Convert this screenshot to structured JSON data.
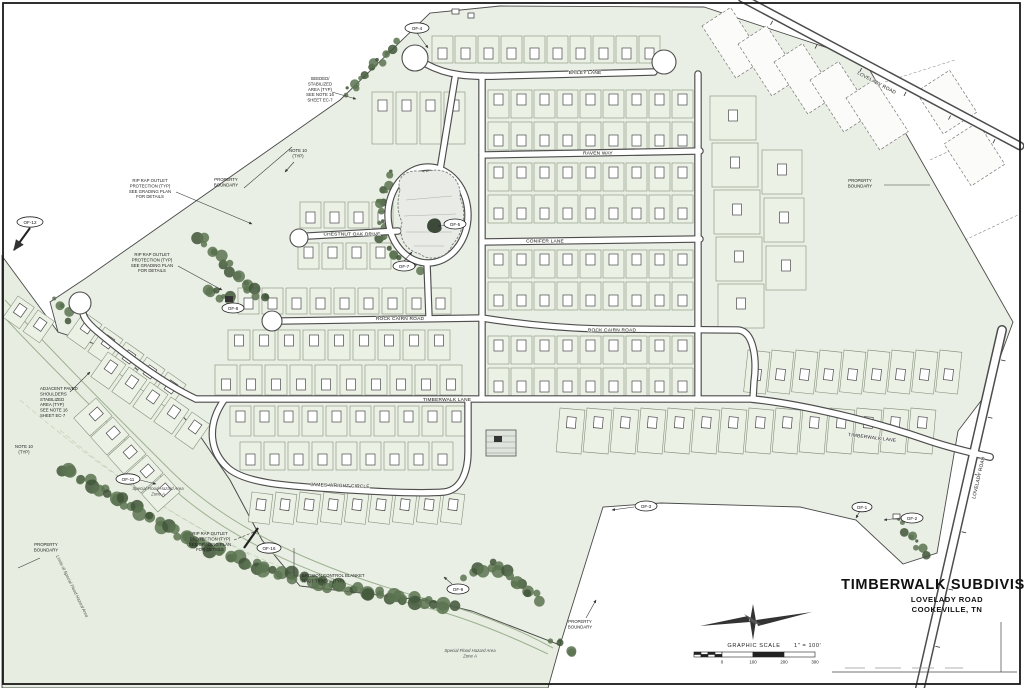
{
  "title_block": {
    "title": "TIMBERWALK SUBDIVISION",
    "road": "LOVELADY ROAD",
    "city": "COOKEVILLE, TN"
  },
  "scale_bar": {
    "label": "GRAPHIC SCALE",
    "ratio": "1\" = 100'",
    "ticks": [
      "0",
      "100",
      "200",
      "300"
    ]
  },
  "streets": {
    "bailey": "BAILEY LANE",
    "raven": "RAVEN WAY",
    "conifer": "CONIFER LANE",
    "rock_cairn_w": "ROCK CAIRN ROAD",
    "rock_cairn_e": "ROCK CAIRN ROAD",
    "chestnut": "CHESTNUT OAK DRIVE",
    "timberwalk_w": "TIMBERWALK LANE",
    "timberwalk_e": "TIMBERWALK LANE",
    "james_wright": "JAMES WRIGHT CIRCLE",
    "lovelady": "LOVELADY ROAD"
  },
  "callouts": {
    "of_12": "OF-12",
    "of_4": "OF-4",
    "of_5": "OF-5",
    "of_7": "OF-7",
    "of_8": "OF-8",
    "of_11": "OF-11",
    "of_16": "OF-16",
    "of_9": "OF-9",
    "of_3": "OF-3",
    "of_1": "OF-1",
    "of_2": "OF-2"
  },
  "notes": {
    "seeded_area": "SEEDED/\nSTABILIZED\nAREA (TYP)\nSEE NOTE 16\nSHEET EC-7",
    "rip_rap": "RIP RAP OUTLET\nPROTECTION (TYP)\nSEE GRADING PLAN\nFOR DETAILS",
    "property_boundary": "PROPERTY\nBOUNDARY",
    "note_10": "NOTE 10\n(TYP)",
    "adjacent_area": "ADJACENT PAVED\nSHOULDERS\nSTABILIZED\nAREA (TYP)\nSEE NOTE 16\nSHEET EC-7",
    "erosion_blanket": "EROSION CONTROL BLANKET\nNAGT TYPE IV (TYP)",
    "flood_zone": "Special Flood Hazard Area\nZone A",
    "flood_limits": "Limits of Special Flood Hazard Area"
  }
}
